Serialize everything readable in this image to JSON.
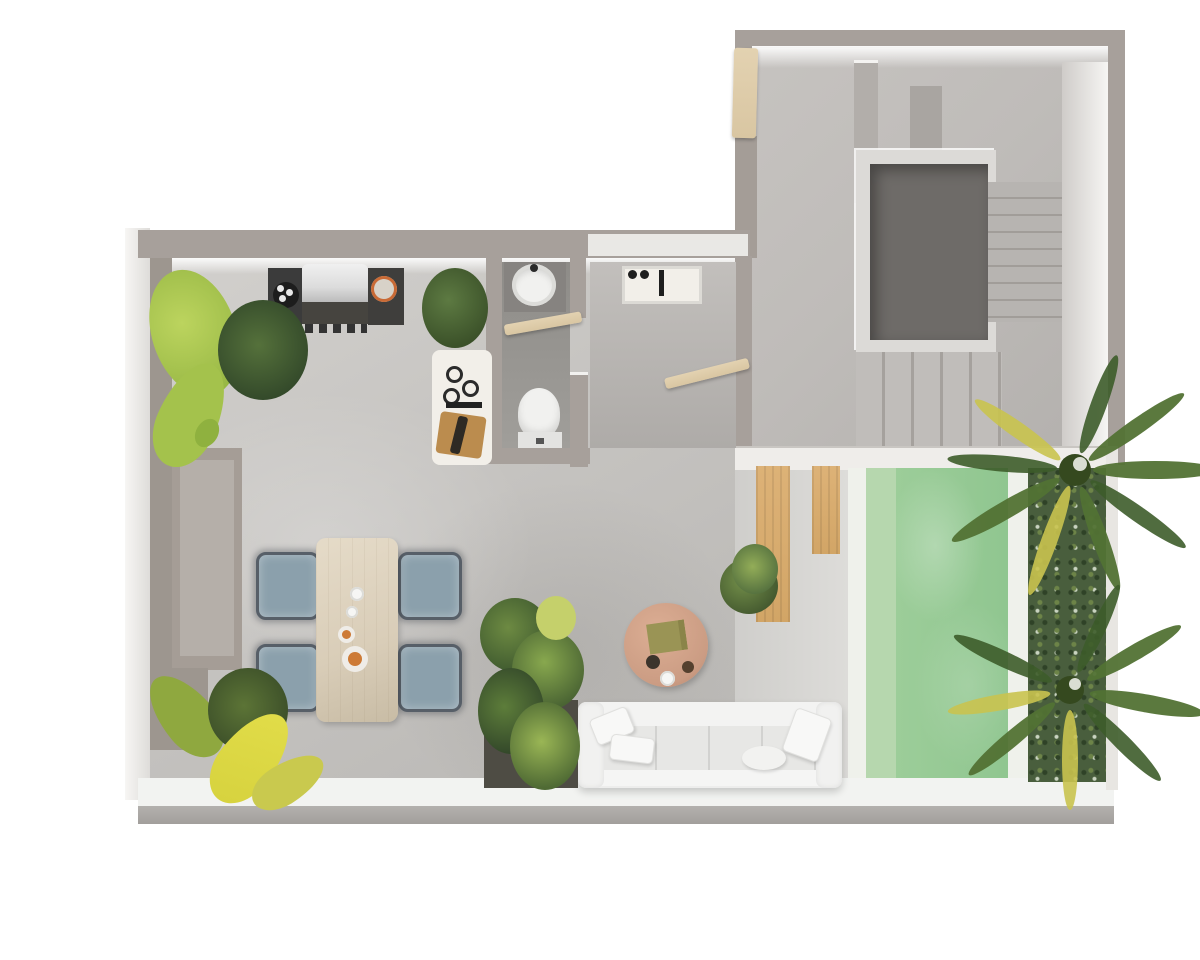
{
  "meta": {
    "type": "3d-floor-plan-render",
    "view": "top-down",
    "background": "#ffffff",
    "description": "Photorealistic top-down 3D floor plan of an apartment with open kitchen/dining/living space, bathroom, utility hall, entry stair hall with staircase and stairwell void, and a pool terrace with hedge wall and palm trees"
  },
  "palette": {
    "bg": "#ffffff",
    "wall": "#a7a09b",
    "wallWhite": "#efedea",
    "floor": "#c6c4c1",
    "floorStair": "#bfbcb9",
    "stairVoid": "#6e6b68",
    "steps": "#b7b4b1",
    "walkway": "#f2f3f1",
    "walkwayEdge": "#b3b1ae",
    "poolLedge": "#b6d7ae",
    "poolWater": "#9ccd99",
    "poolDeep": "#90c690",
    "poolCoping": "#eff1eb",
    "deckWood": "#d2a566",
    "hedge": "#495e3d",
    "palm": "#527234",
    "palmYellow": "#c9c34f",
    "door": "#d9c6a2",
    "sofa": "#ededec",
    "table": "#d9cdb8",
    "chairSeat": "#8ba0ac",
    "chairTrim": "#575f68",
    "coffeeTable": "#cb9c83",
    "grillDark": "#3b3b3b",
    "grillLid": "#dcdcdc",
    "planter": "#4e4c44",
    "foliage": "#41572f",
    "foliageLight": "#88a84e",
    "leafYellow": "#d6d23e",
    "consoleWhite": "#f2efe9",
    "board": "#bb8c4e",
    "fixtureWhite": "#f1f1ef"
  },
  "rooms": [
    {
      "id": "kitchen-living",
      "name": "Open kitchen / dining / living area"
    },
    {
      "id": "bathroom",
      "name": "Bathroom with basin and toilet"
    },
    {
      "id": "utility-hall",
      "name": "Utility hall with counter sink"
    },
    {
      "id": "stair-hall",
      "name": "Entry stair hall"
    },
    {
      "id": "staircase",
      "name": "Staircase with stairwell void"
    },
    {
      "id": "pool-terrace",
      "name": "Pool terrace with wood deck"
    }
  ],
  "furniture": [
    {
      "id": "bbq-grill",
      "name": "BBQ grill unit with burner and food plate"
    },
    {
      "id": "console-table",
      "name": "White console table with candles, cutting board and bottle"
    },
    {
      "id": "dining-table",
      "name": "Light wood dining table with cups and plates"
    },
    {
      "id": "dining-chairs",
      "name": "Four fringed dining chairs with blue-gray seats",
      "count": 4
    },
    {
      "id": "sofa",
      "name": "White four-seat sofa with pillows"
    },
    {
      "id": "coffee-table",
      "name": "Round wood coffee table with book, bowls and cup"
    },
    {
      "id": "wash-basin",
      "name": "Oval wash basin"
    },
    {
      "id": "toilet",
      "name": "Toilet"
    },
    {
      "id": "utility-sink",
      "name": "Counter sink with black taps"
    },
    {
      "id": "bench",
      "name": "Built-in bench along left wall"
    },
    {
      "id": "doors",
      "name": "Three tan swing doors (entry, bathroom, hall)",
      "count": 3
    }
  ],
  "plants": [
    {
      "id": "plant-top-left",
      "name": "Banana-leaf plant with dark fern"
    },
    {
      "id": "bush-kitchen",
      "name": "Green bush beside grill"
    },
    {
      "id": "planter-center",
      "name": "Tall dark planter with lush foliage"
    },
    {
      "id": "bush-pool",
      "name": "Round bush near pool walkway"
    },
    {
      "id": "plant-bottom-left",
      "name": "Yellow-green plant at bottom-left corner"
    },
    {
      "id": "palm-upper",
      "name": "Palm tree over pool, upper"
    },
    {
      "id": "palm-lower",
      "name": "Palm tree over pool, lower"
    }
  ],
  "pool": {
    "water_color_name": "mint green",
    "features": [
      "tanning ledge strip",
      "white coping",
      "hedge privacy wall"
    ]
  }
}
